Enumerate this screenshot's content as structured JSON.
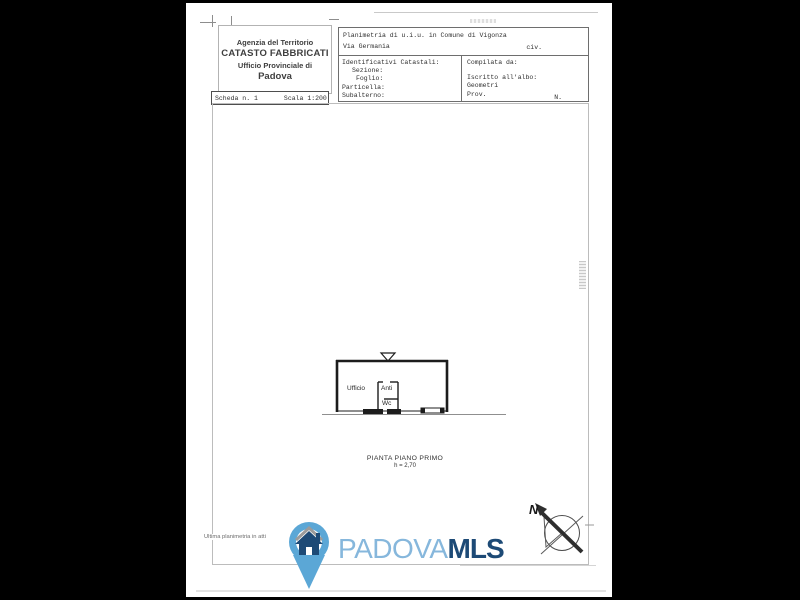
{
  "page": {
    "background_color": "#000000",
    "paper_color": "#ffffff"
  },
  "header": {
    "agency": {
      "line1": "Agenzia del Territorio",
      "line2": "CATASTO FABBRICATI",
      "line3": "Ufficio Provinciale di",
      "line4": "Padova"
    },
    "scheda": {
      "number_label": "Scheda n. 1",
      "scale_label": "Scala 1:200"
    },
    "location": {
      "line1": "Planimetria di u.i.u. in Comune di Vigonza",
      "line2": "Via Germania",
      "civ": "civ."
    },
    "catastali": {
      "title": "Identificativi Catastali:",
      "sezione": "Sezione:",
      "foglio": "Foglio:",
      "particella": "Particella:",
      "subalterno": "Subalterno:"
    },
    "compilata": {
      "title": "Compilata da:",
      "albo_label": "Iscritto all'albo:",
      "albo_value": "Geometri",
      "prov": "Prov.",
      "n": "N."
    }
  },
  "plan": {
    "rooms": [
      {
        "name": "Ufficio"
      },
      {
        "name": "Anti"
      },
      {
        "name": "Wc"
      }
    ],
    "caption_line1": "PIANTA PIANO PRIMO",
    "caption_line2": "h = 2,70",
    "north_label": "N",
    "wall_color": "#1c1c1c"
  },
  "footer": {
    "note": "Ultima planimetria in atti",
    "logo": {
      "text_light": "PADOVA",
      "text_bold": "MLS",
      "pin_color": "#5ba7d6",
      "light_text_color": "#86b7dc",
      "dark_text_color": "#1d4a76"
    }
  }
}
